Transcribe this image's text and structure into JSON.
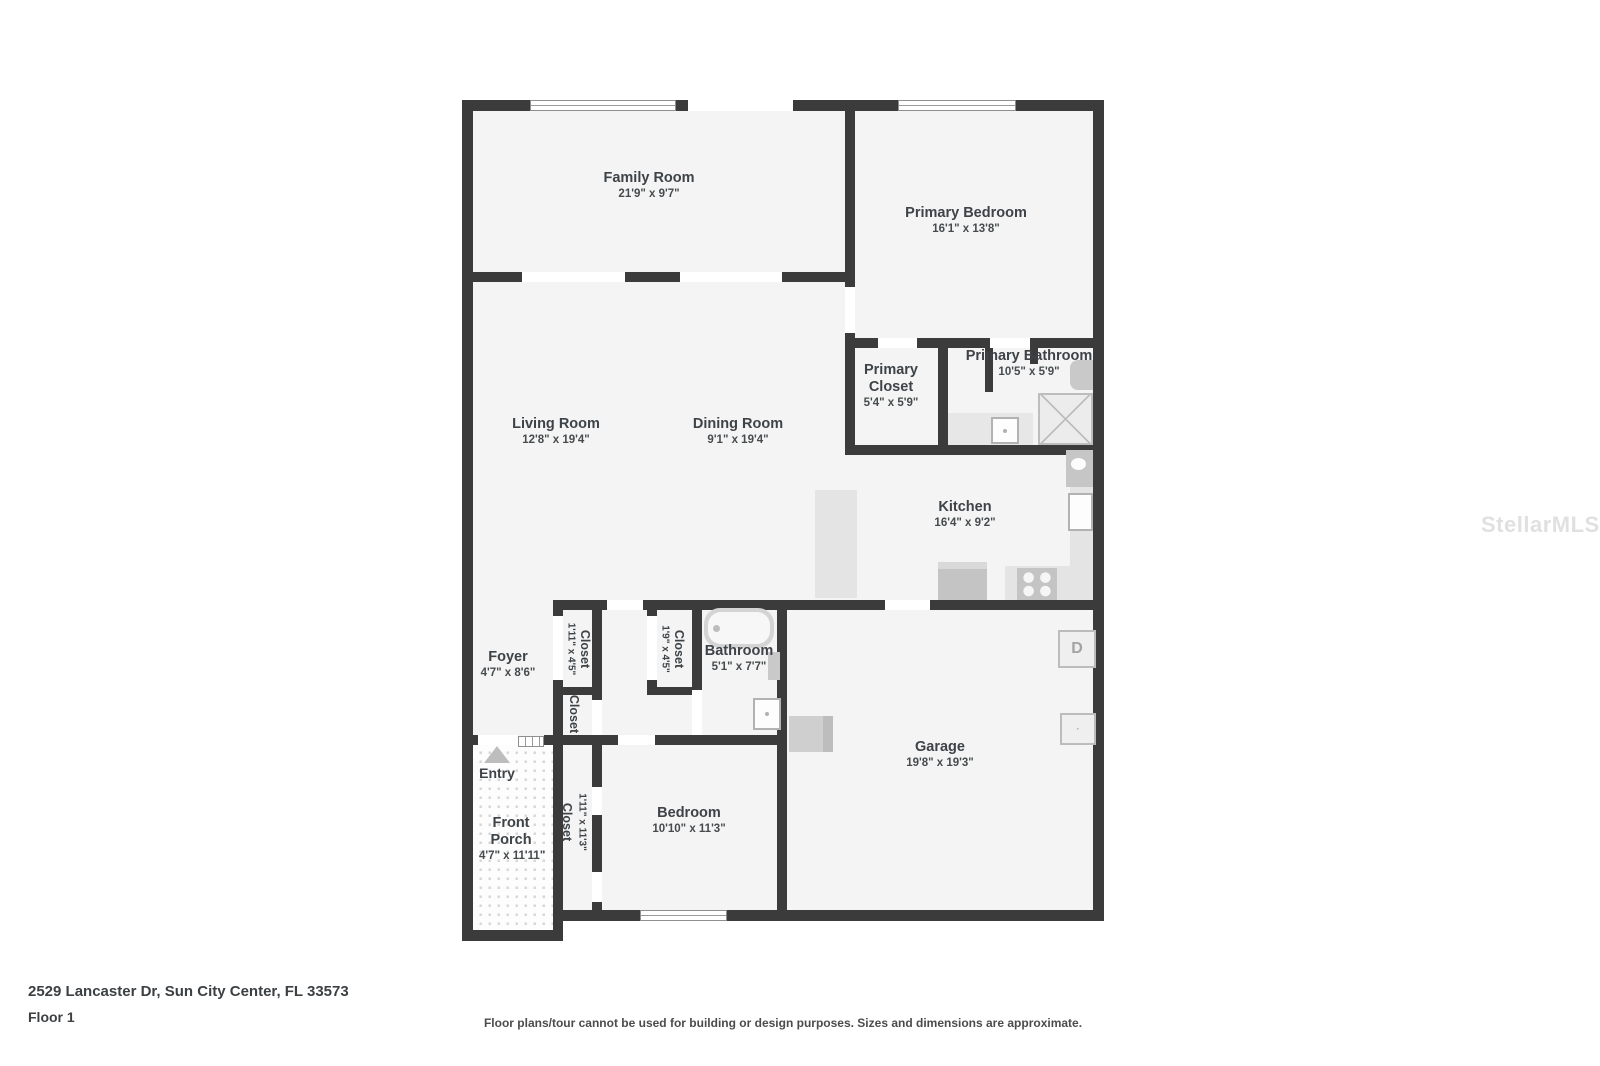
{
  "address": "2529 Lancaster Dr, Sun City Center, FL 33573",
  "floor_label": "Floor 1",
  "disclaimer": "Floor plans/tour cannot be used for building or design purposes. Sizes and dimensions are approximate.",
  "watermark": "StellarMLS",
  "colors": {
    "wall": "#3b3b3b",
    "room_fill": "#f4f4f4",
    "fixture_gray": "#c6c6c6",
    "counter_gray": "#e4e4e4",
    "label_text": "#3e4347"
  },
  "rooms": {
    "family_room": {
      "name": "Family Room",
      "dims": "21'9\" x 9'7\""
    },
    "primary_bedroom": {
      "name": "Primary Bedroom",
      "dims": "16'1\" x 13'8\""
    },
    "primary_closet": {
      "name": "Primary Closet",
      "dims": "5'4\" x 5'9\""
    },
    "primary_bathroom": {
      "name": "Primary Bathroom",
      "dims": "10'5\" x 5'9\""
    },
    "living_room": {
      "name": "Living Room",
      "dims": "12'8\" x 19'4\""
    },
    "dining_room": {
      "name": "Dining Room",
      "dims": "9'1\" x 19'4\""
    },
    "kitchen": {
      "name": "Kitchen",
      "dims": "16'4\" x 9'2\""
    },
    "foyer": {
      "name": "Foyer",
      "dims": "4'7\" x 8'6\""
    },
    "closet_hall_a": {
      "name": "Closet",
      "dims": "1'11\" x 4'5\""
    },
    "closet_hall_b": {
      "name": "Closet",
      "dims": "1'9\" x 4'5\""
    },
    "closet_hall_c": {
      "name": "Closet"
    },
    "bathroom": {
      "name": "Bathroom",
      "dims": "5'1\" x 7'7\""
    },
    "entry": {
      "name": "Entry"
    },
    "front_porch": {
      "name": "Front Porch",
      "dims": "4'7\" x 11'11\""
    },
    "bedroom_closet": {
      "name": "Closet",
      "dims": "1'11\" x 11'3\""
    },
    "bedroom": {
      "name": "Bedroom",
      "dims": "10'10\" x 11'3\""
    },
    "garage": {
      "name": "Garage",
      "dims": "19'8\" x 19'3\""
    }
  },
  "fixtures": {
    "dryer_label": "D"
  }
}
